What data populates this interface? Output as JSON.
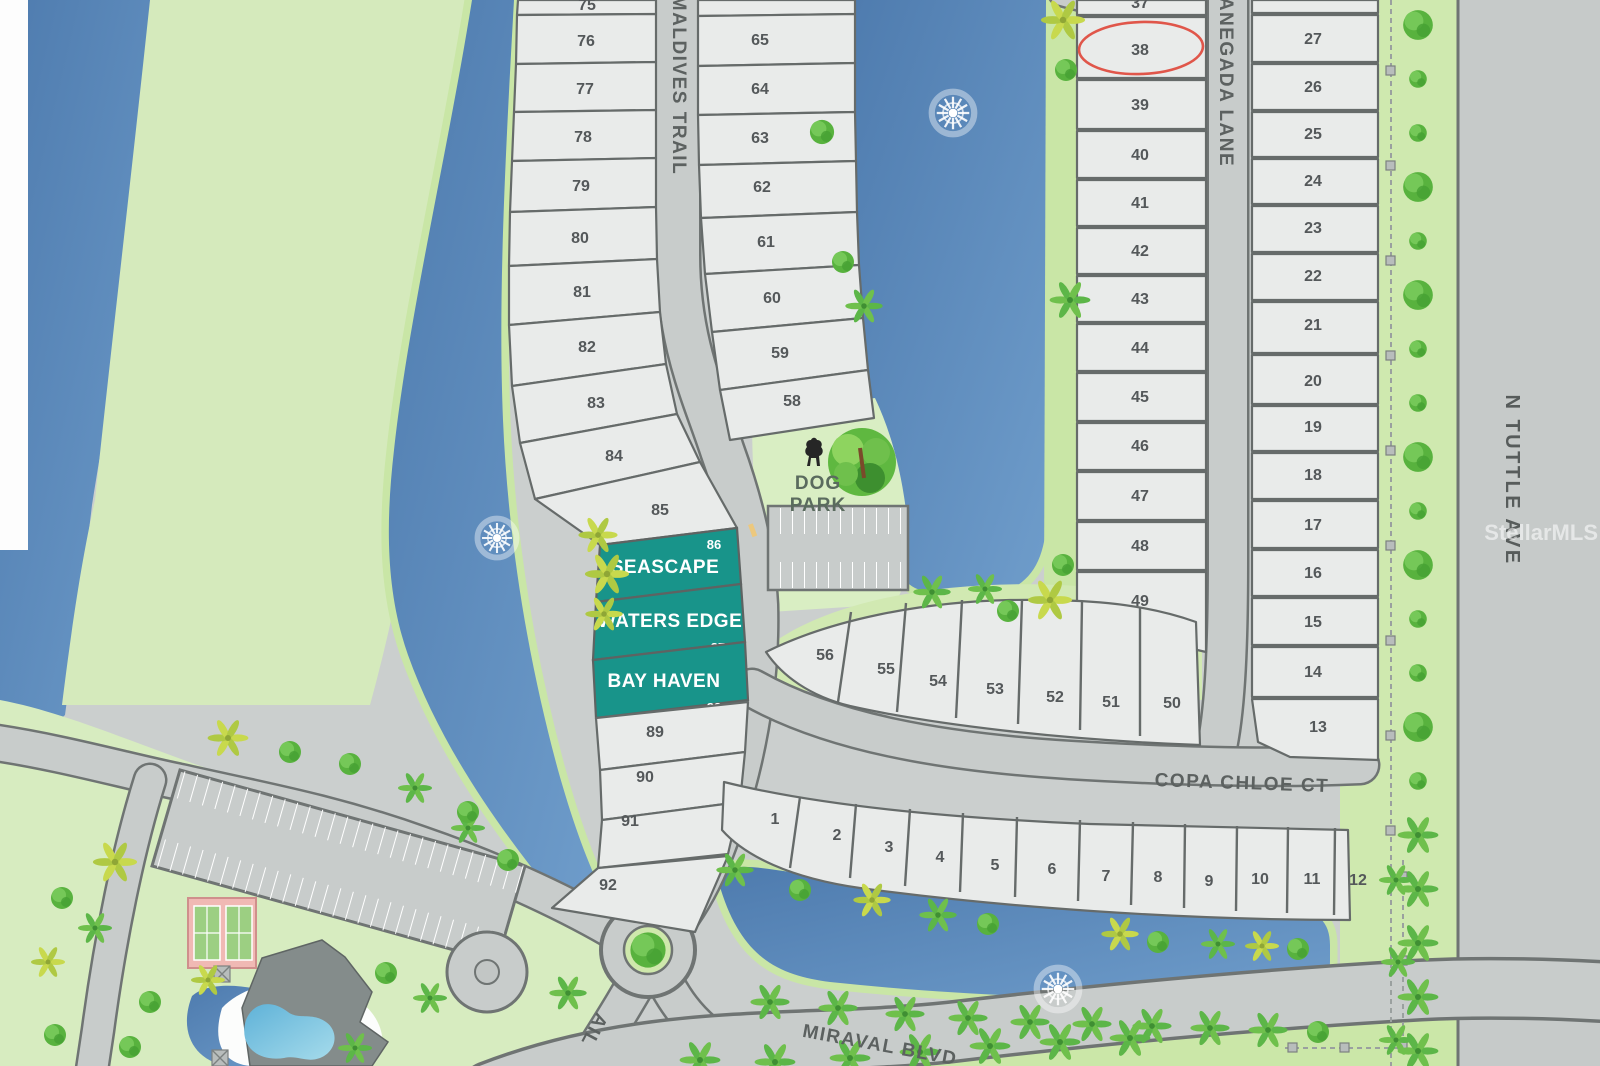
{
  "watermark": "StellarMLS",
  "streets": {
    "maldives_trail": "MALDIVES TRAIL",
    "maldives_trail_partial": "AIL",
    "anegada_lane": "ANEGADA LANE",
    "n_tuttle_ave": "N TUTTLE AVE",
    "copa_chloe_ct": "COPA CHLOE CT",
    "miraval_blvd": "MIRAVAL BLVD"
  },
  "amenities": {
    "dog_park_line1": "DOG",
    "dog_park_line2": "PARK"
  },
  "featured_lots": {
    "seascape": {
      "number": "86",
      "name": "SEASCAPE"
    },
    "waters_edge": {
      "number": "87",
      "name": "WATERS EDGE"
    },
    "bay_haven": {
      "number": "88",
      "name": "BAY HAVEN"
    }
  },
  "highlighted_lot": {
    "number": "38"
  },
  "lots": {
    "maldives_west": [
      "75",
      "76",
      "77",
      "78",
      "79",
      "80",
      "81",
      "82",
      "83",
      "84",
      "85"
    ],
    "maldives_west_lower": [
      "89",
      "90",
      "91",
      "92"
    ],
    "maldives_east": [
      "65",
      "64",
      "63",
      "62",
      "61",
      "60",
      "59",
      "58"
    ],
    "anegada_west": [
      "37",
      "38",
      "39",
      "40",
      "41",
      "42",
      "43",
      "44",
      "45",
      "46",
      "47",
      "48",
      "49"
    ],
    "anegada_east": [
      "27",
      "26",
      "25",
      "24",
      "23",
      "22",
      "21",
      "20",
      "19",
      "18",
      "17",
      "16",
      "15",
      "14",
      "13"
    ],
    "copa_north": [
      "56",
      "55",
      "54",
      "53",
      "52",
      "51",
      "50"
    ],
    "copa_south": [
      "1",
      "2",
      "3",
      "4",
      "5",
      "6",
      "7",
      "8",
      "9",
      "10",
      "11",
      "12"
    ]
  },
  "colors": {
    "water": "#4E7BAE",
    "park_green": "#D5EABC",
    "road": "#C8CCCB",
    "lot_fill": "#E9EBEA",
    "featured_teal": "#18948A",
    "highlight_red": "#E0564A"
  }
}
